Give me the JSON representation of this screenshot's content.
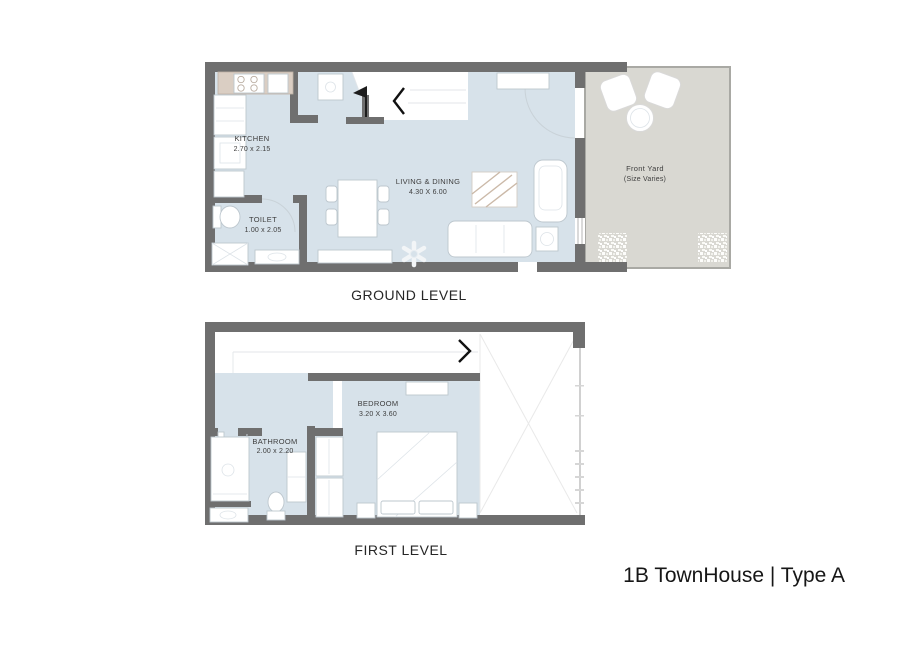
{
  "page": {
    "title": "1B TownHouse | Type A"
  },
  "ground_level": {
    "caption": "GROUND LEVEL",
    "rooms": {
      "kitchen": {
        "name": "KITCHEN",
        "dims": "2.70 x 2.15"
      },
      "toilet": {
        "name": "TOILET",
        "dims": "1.00 x 2.05"
      },
      "living_dining": {
        "name": "LIVING & DINING",
        "dims": "4.30 X 6.00"
      },
      "front_yard": {
        "name": "Front Yard",
        "dims": "(Size Varies)"
      }
    }
  },
  "first_level": {
    "caption": "FIRST LEVEL",
    "rooms": {
      "bedroom": {
        "name": "BEDROOM",
        "dims": "3.20 X 3.60"
      },
      "bathroom": {
        "name": "BATHROOM",
        "dims": "2.00 x 2.20"
      }
    }
  },
  "colors": {
    "wall": "#6f6f6f",
    "floor": "#d7e2ea",
    "yard_fill": "#d9d8d2",
    "yard_wall": "#a9a9a4",
    "counter": "#dacec3",
    "label": "#3e3e3e"
  }
}
